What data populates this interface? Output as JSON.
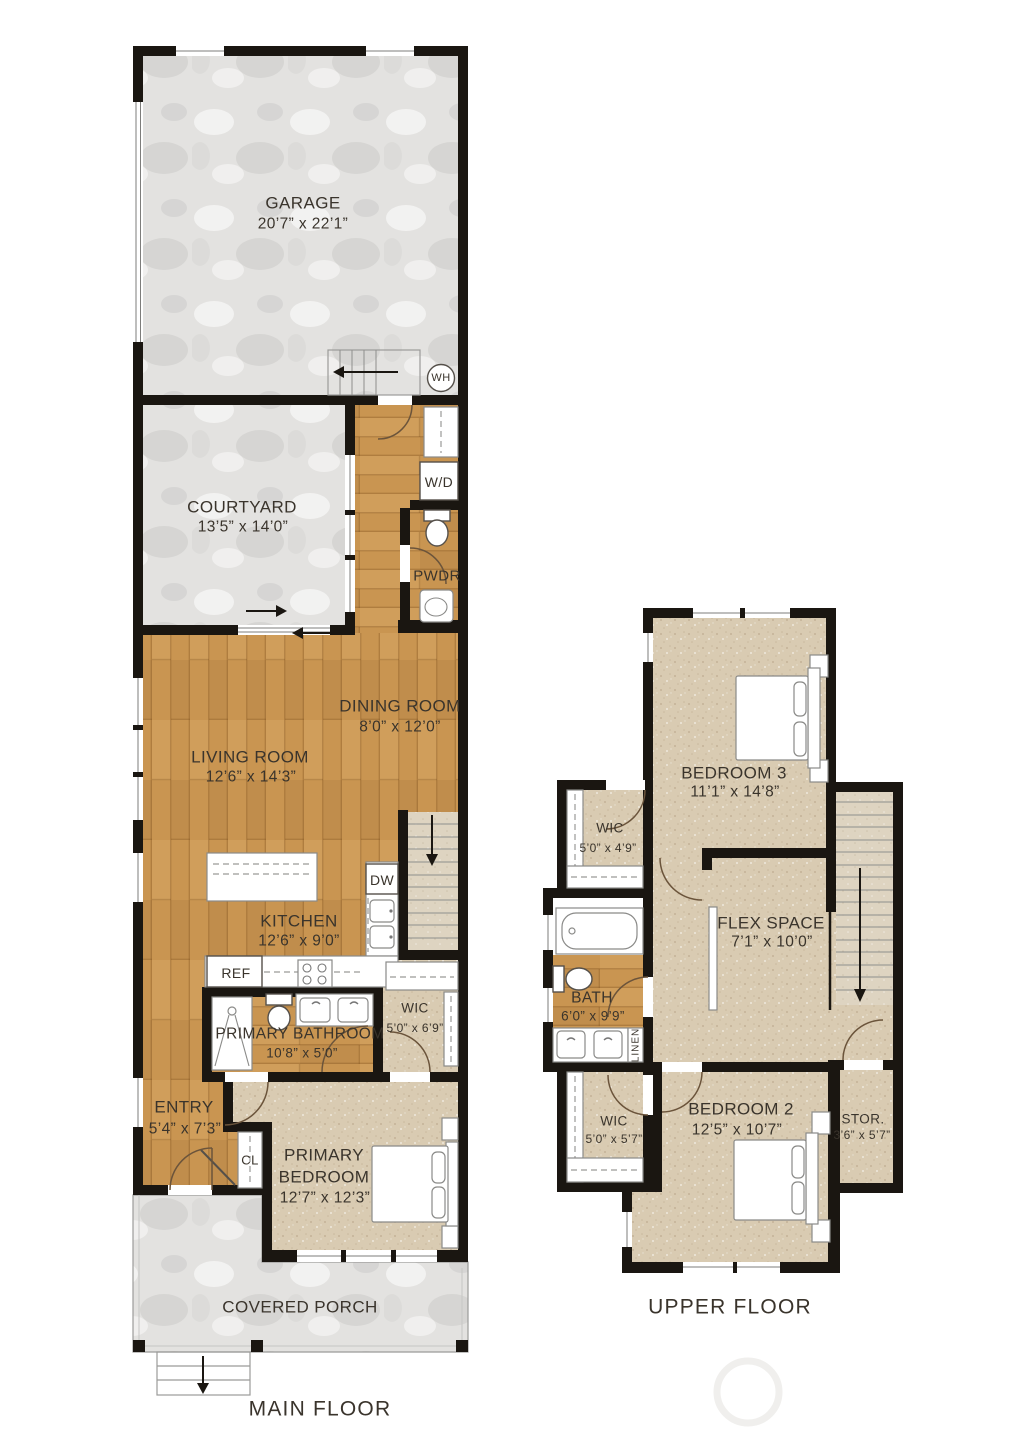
{
  "document": {
    "type": "residential floor plan",
    "floors": 2
  },
  "colors": {
    "wall": "#1a1611",
    "wood_floor": "#c99551",
    "carpet": "#d9cbb2",
    "concrete": "#e3e2e0",
    "label_text": "#3a342c"
  },
  "main_floor": {
    "title": "MAIN FLOOR",
    "rooms": {
      "garage": {
        "name": "GARAGE",
        "dims": "20’7” x 22’1”"
      },
      "courtyard": {
        "name": "COURTYARD",
        "dims": "13’5” x 14’0”"
      },
      "dining": {
        "name": "DINING ROOM",
        "dims": "8’0” x 12’0”"
      },
      "living": {
        "name": "LIVING ROOM",
        "dims": "12’6” x 14’3”"
      },
      "kitchen": {
        "name": "KITCHEN",
        "dims": "12’6” x 9’0”"
      },
      "primary_bathroom": {
        "name": "PRIMARY BATHROOM",
        "dims": "10’8” x 5’0”"
      },
      "wic": {
        "name": "WIC",
        "dims": "5’0” x 6’9”"
      },
      "entry": {
        "name": "ENTRY",
        "dims": "5’4” x 7’3”"
      },
      "primary_bedroom": {
        "name_lines": [
          "PRIMARY",
          "BEDROOM"
        ],
        "dims": "12’7” x 12’3”"
      },
      "covered_porch": {
        "name": "COVERED PORCH"
      }
    },
    "labels": {
      "wh": "WH",
      "wd": "W/D",
      "pwdr": "PWDR",
      "dw": "DW",
      "ref": "REF",
      "cl": "CL"
    }
  },
  "upper_floor": {
    "title": "UPPER FLOOR",
    "rooms": {
      "bedroom3": {
        "name": "BEDROOM 3",
        "dims": "11’1” x 14’8”"
      },
      "wic_upper": {
        "name": "WIC",
        "dims": "5’0” x 4’9”"
      },
      "flex": {
        "name": "FLEX SPACE",
        "dims": "7’1” x 10’0”"
      },
      "bath": {
        "name": "BATH",
        "dims": "6’0” x 9’9”"
      },
      "wic_lower": {
        "name": "WIC",
        "dims": "5’0” x 5’7”"
      },
      "bedroom2": {
        "name": "BEDROOM 2",
        "dims": "12’5” x 10’7”"
      },
      "storage": {
        "name": "STOR.",
        "dims": "3’6” x 5’7”"
      }
    },
    "labels": {
      "linen": "LINEN"
    }
  }
}
